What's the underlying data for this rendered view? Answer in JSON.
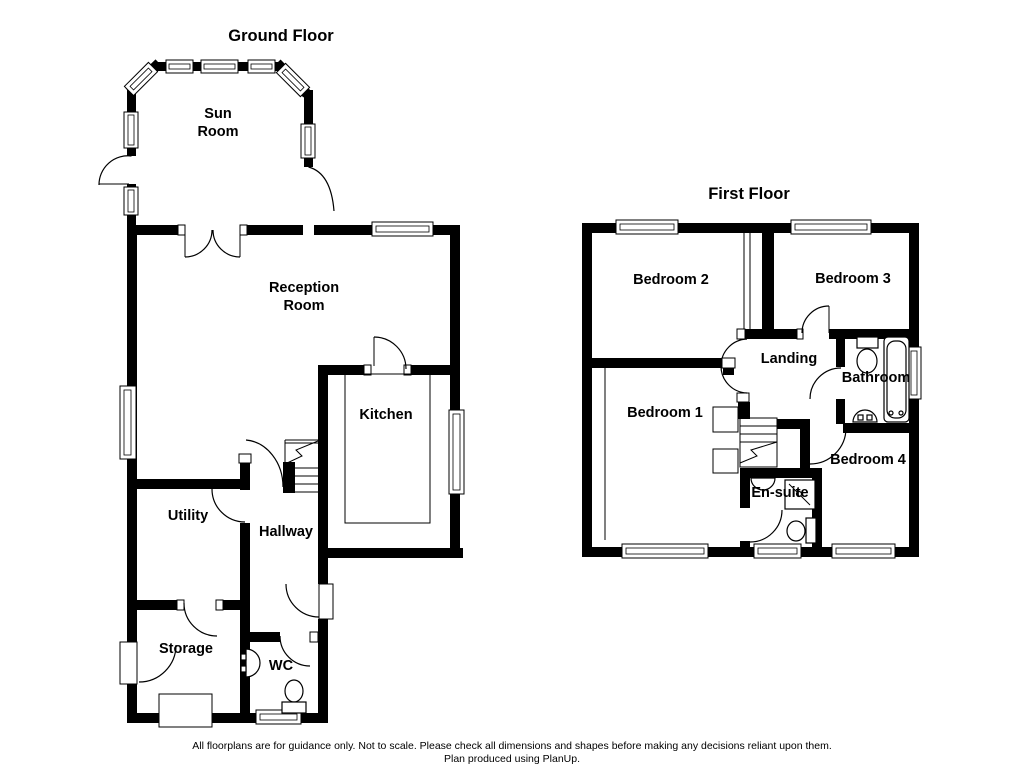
{
  "ground_floor": {
    "title": "Ground Floor",
    "rooms": {
      "sun_room_line1": "Sun",
      "sun_room_line2": "Room",
      "reception_line1": "Reception",
      "reception_line2": "Room",
      "kitchen": "Kitchen",
      "utility": "Utility",
      "hallway": "Hallway",
      "storage": "Storage",
      "wc": "WC"
    }
  },
  "first_floor": {
    "title": "First Floor",
    "rooms": {
      "bedroom1": "Bedroom 1",
      "bedroom2": "Bedroom 2",
      "bedroom3": "Bedroom 3",
      "bedroom4": "Bedroom 4",
      "landing": "Landing",
      "bathroom": "Bathroom",
      "ensuite": "En-suite"
    }
  },
  "footer": {
    "line1": "All floorplans are for guidance only. Not to scale. Please check all dimensions and shapes before making any decisions reliant upon them.",
    "line2": "Plan produced using PlanUp."
  },
  "colors": {
    "wall": "#000000",
    "background": "#ffffff"
  }
}
